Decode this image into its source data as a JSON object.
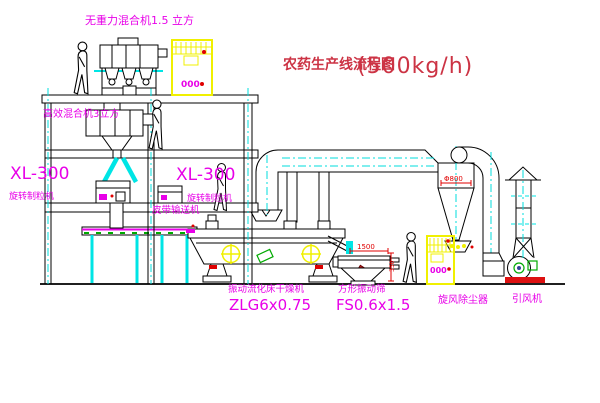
{
  "title": {
    "main": "农药生产线流程图",
    "capacity": "(500kg/h)"
  },
  "labels": {
    "mixer_top": "无重力混合机1.5 立方",
    "mixer_floor2": "高效混合机3立方",
    "xl300_left": "XL-300",
    "granulator_left": "旋转制粒机",
    "xl300_mid": "XL-300",
    "granulator_mid": "旋转制粒机",
    "belt_conveyor": "皮带输送机",
    "dryer_name": "振动流化床干燥机",
    "dryer_model": "ZLG6x0.75",
    "screen_name": "方形振动筛",
    "screen_model": "FS0.6x1.5",
    "cyclone": "旋风除尘器",
    "fan": "引风机"
  },
  "dimensions": {
    "screen_width": "1500",
    "screen_height": "350",
    "cyclone_inlet": "Φ800"
  },
  "cabinets": {
    "cabinet1_display": "000",
    "cabinet2_display": "000"
  },
  "colors": {
    "background": "#FFFFFF",
    "line_black": "#000000",
    "label_magenta": "#E800E8",
    "centerline_cyan": "#00E5E5",
    "title_red": "#CC3344",
    "dimension_red": "#E00000",
    "cabinet_yellow": "#F0F000",
    "accent_green": "#00AA00"
  }
}
